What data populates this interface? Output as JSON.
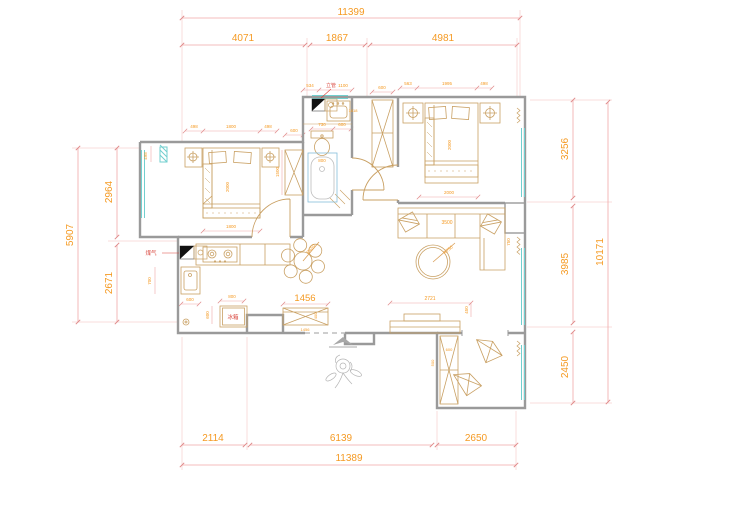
{
  "meta": {
    "drawing_type": "residential floor plan",
    "units": "mm"
  },
  "colors": {
    "wall": "#9a9a9a",
    "furniture": "#c9a063",
    "dimension_line": "#f0a8a8",
    "dimension_text": "#f59a23",
    "window": "#72cfcf",
    "bathtub": "#85bedb",
    "red_label": "#d9453c",
    "decor_grey": "#b5b5b5",
    "marker_black": "#111111"
  },
  "dims": {
    "top_total": "11399",
    "top_1": "4071",
    "top_2": "1867",
    "top_3": "4981",
    "bottom_1": "2114",
    "bottom_2": "6139",
    "bottom_3": "2650",
    "bottom_total": "11389",
    "left_1": "2964",
    "left_2": "2671",
    "left_total": "5907",
    "left_window": "498",
    "right_1": "3256",
    "right_2": "3985",
    "right_3": "2450",
    "right_total": "10171",
    "bed1_left": "498",
    "bed1_width": "1800",
    "bed1_right": "498",
    "bed1_wardrobe": "600",
    "bed1_wardrobe_h": "1500",
    "bed1_length": "2000",
    "bed1_bottom": "1800",
    "bath_1": "534",
    "bath_2": "1100",
    "bath_basin": "730",
    "bath_wc": "600",
    "bath_tub": "800",
    "bath_tag": "1818",
    "hall_wardrobe": "600",
    "bed2_left": "563",
    "bed2_width": "1995",
    "bed2_right": "498",
    "bed2_length": "2000",
    "bed2_bottom": "2000",
    "sofa_width": "3500",
    "sofa_depth": "750",
    "rug_radius": "R750",
    "table_radius": "R650",
    "tv_wall": "2721",
    "tv_side": "450",
    "shoe_cabinet": "1456",
    "shoe_cabinet_sub": "1456",
    "shoe_depth": "400",
    "kitchen_side": "700",
    "kitchen_1": "600",
    "kitchen_fridge": "800",
    "kitchen_2": "600",
    "leisure_cabinet": "600",
    "leisure_depth": "500"
  },
  "labels": {
    "gas_riser": "煤气",
    "pipe_riser": "立管",
    "fridge": "冰箱"
  }
}
